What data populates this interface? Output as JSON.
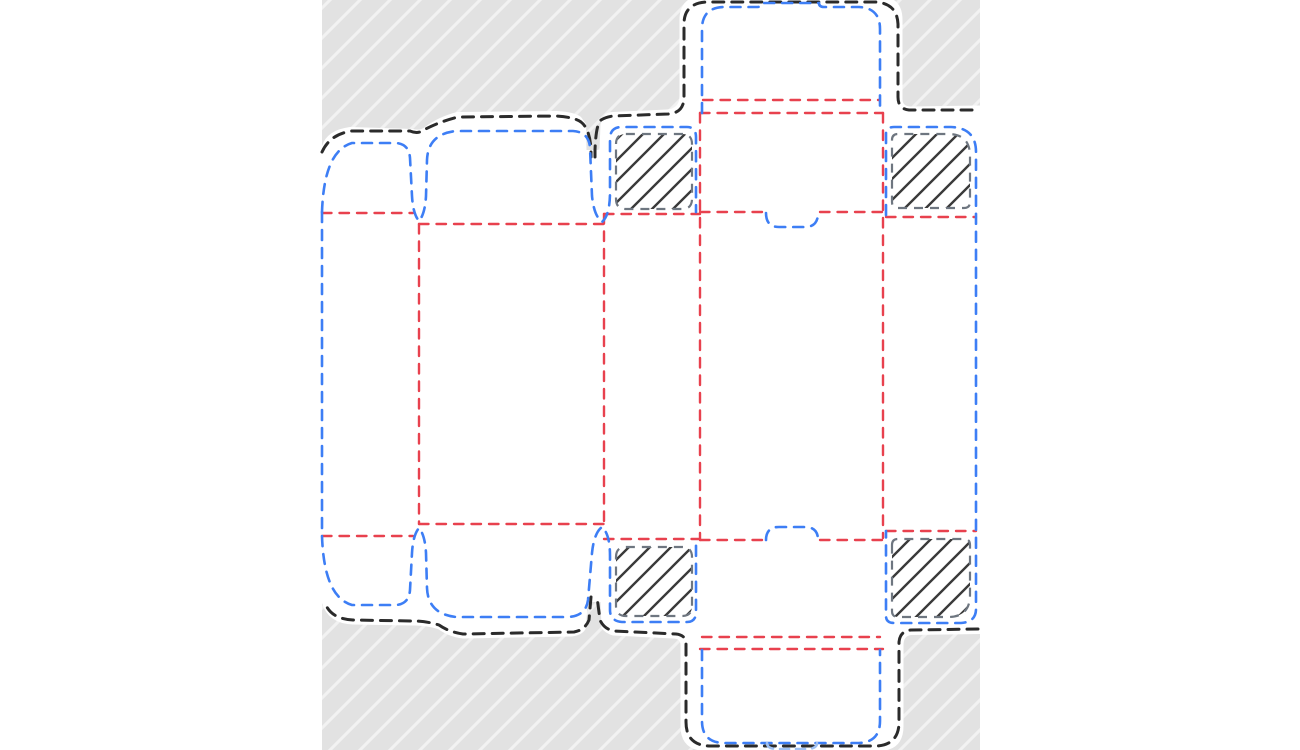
{
  "document": {
    "type": "packaging-dieline-template",
    "visible_text": "",
    "parts": [
      {
        "name": "artboard",
        "description": "gray hatched canvas area behind the die shape"
      },
      {
        "name": "die-cut-silhouette",
        "description": "white punched-out blank of the folding carton"
      },
      {
        "name": "outer-bleed-outline",
        "line_style": "black dashed"
      },
      {
        "name": "cut-lines",
        "line_style": "blue dashed",
        "elements": [
          "side flap top",
          "main flap top",
          "tuck flap top with lock bump",
          "tuck flap bottom with lock bump",
          "side flap bottom",
          "main flap bottom",
          "glue panel edge",
          "lock slot top",
          "lock slot bottom"
        ]
      },
      {
        "name": "crease-lines",
        "line_style": "red dashed",
        "elements": [
          "panel folds vertical x4",
          "flap folds horizontal",
          "double tuck folds top",
          "double tuck folds bottom"
        ]
      },
      {
        "name": "glue-areas",
        "line_style": "gray dashed with diagonal hatch",
        "count": 4
      }
    ]
  },
  "colors": {
    "page_bg": "#ffffff",
    "artboard_bg": "#e2e2e2",
    "artboard_stripe": "#f2f2f2",
    "die_fill": "#ffffff",
    "outer_cut": "#2b2b2b",
    "cut_blue": "#3d7ef5",
    "cut_blue_light": "#9fc0f2",
    "crease_red": "#e8414e",
    "glue_outline": "#6e7680",
    "hatch_line": "#3a3a3a"
  }
}
